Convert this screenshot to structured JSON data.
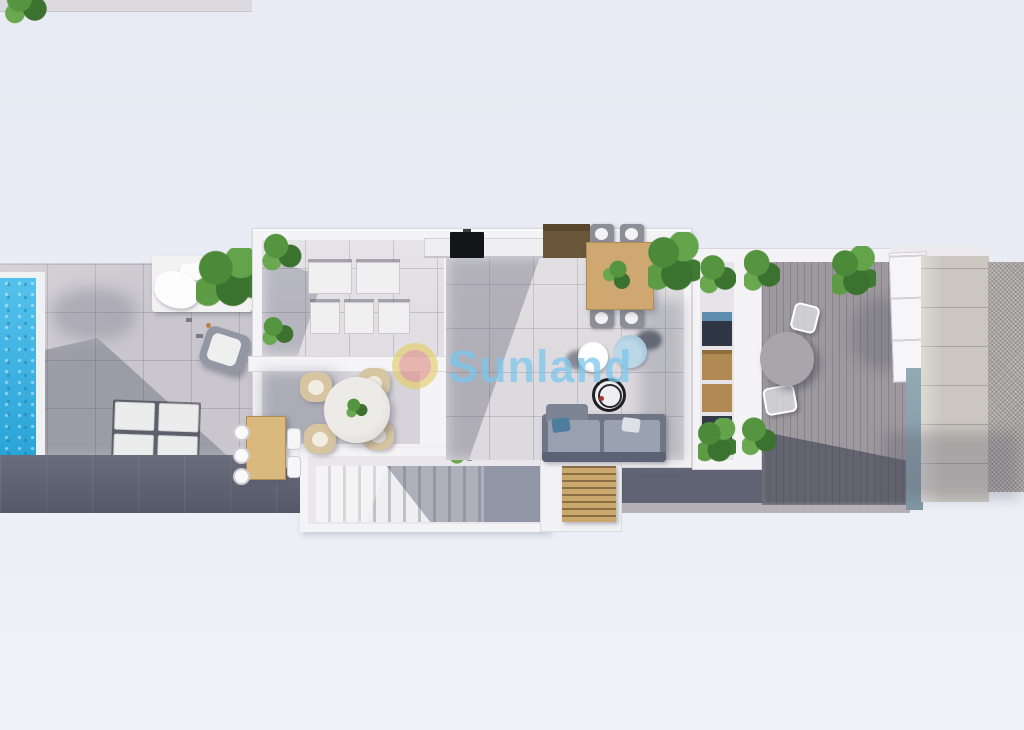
{
  "watermark": {
    "text": "Sunland",
    "registered_mark": "®"
  },
  "colors": {
    "background": "#e9ecf4",
    "pool_water": "#2fb4e8",
    "terrace_tile": "#c9c7cd",
    "walkway_dark": "#5c6070",
    "walkway_dark_right": "#5f6373",
    "wall_white": "#f4f3f5",
    "interior_floor": "#dcdade",
    "lounge_floor": "#e1dfe4",
    "dining_floor": "#d6d4da",
    "wood_light": "#d9b97e",
    "wood_table": "#cfa771",
    "wood_dark": "#6a5639",
    "plant_green": "#4e8a3e",
    "sofa_gray": "#6e7686",
    "armchair_blue": "#9fc2d8",
    "deck_gray": "#9d999e",
    "stone_path": "#cbc6c0",
    "gravel": "#a8a5a2",
    "glass_teal": "#8aa2ae",
    "logo_yellow": "#e3cd62",
    "logo_red": "#dd8b89",
    "watermark_blue": "#7dc7ec"
  }
}
